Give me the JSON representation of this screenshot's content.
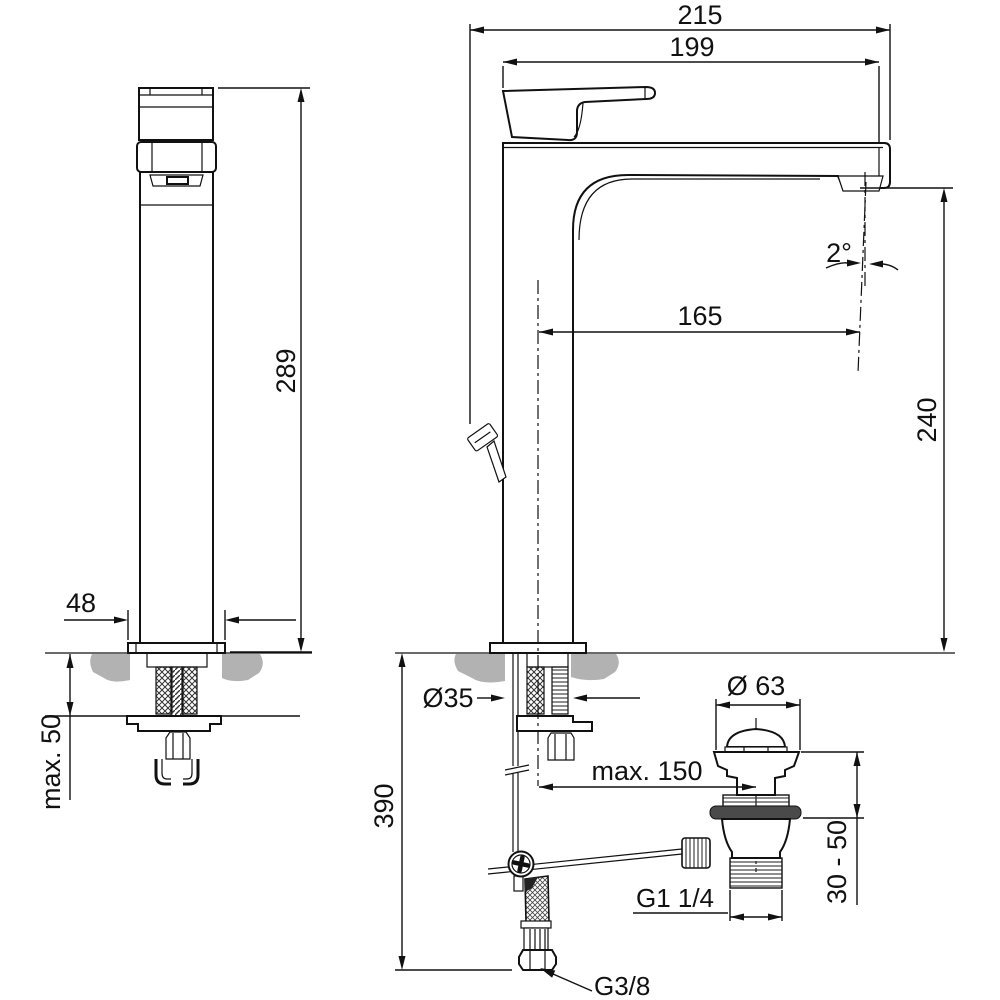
{
  "colors": {
    "line": "#111111",
    "counter_gray": "#b2b2b2",
    "seal_gray": "#4a4a4a",
    "background": "#ffffff"
  },
  "front_view": {
    "dim_height": "289",
    "dim_base_width": "48",
    "dim_counter_thickness": "max. 50"
  },
  "side_view": {
    "dim_total_depth": "215",
    "dim_spout_overall": "199",
    "dim_spout_reach": "165",
    "dim_outlet_height": "240",
    "dim_outlet_angle": "2°",
    "dim_hole_diameter": "Ø35",
    "dim_below_counter": "390",
    "dim_drain_offset": "max. 150",
    "dim_plug_diameter": "Ø 63",
    "dim_clamping_range": "30 - 50",
    "dim_drain_thread": "G1 1/4",
    "dim_inlet_thread": "G3/8"
  }
}
